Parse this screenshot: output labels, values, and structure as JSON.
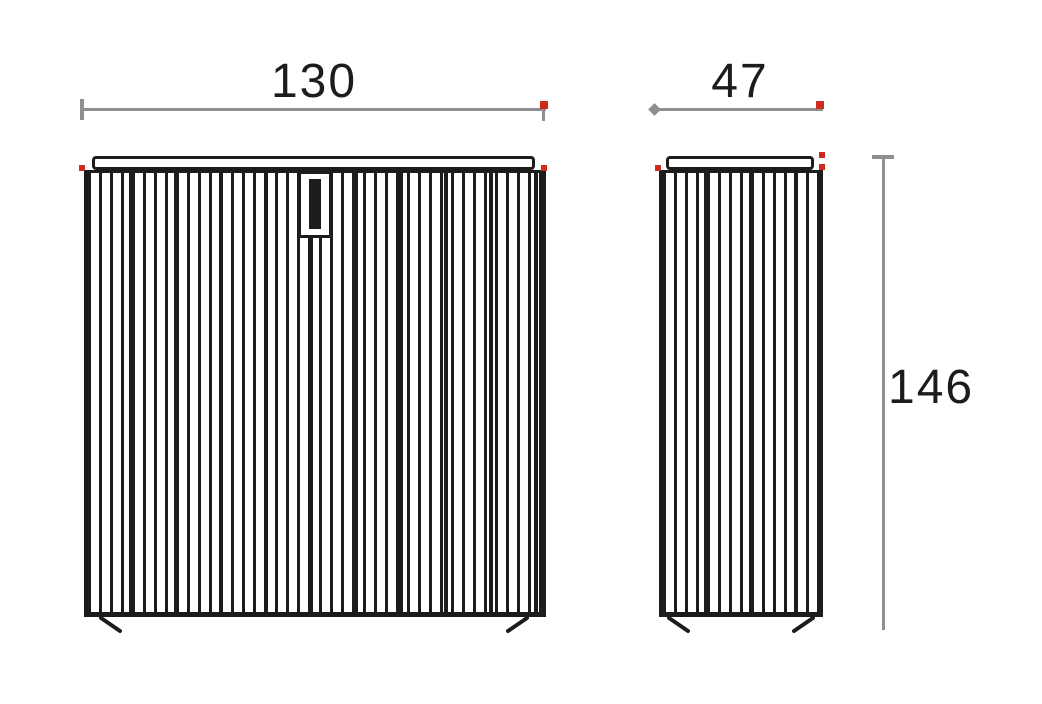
{
  "dimensions": {
    "width": "130",
    "depth": "47",
    "height": "146"
  },
  "views": {
    "front": "front-elevation",
    "side": "side-elevation"
  },
  "markers": {
    "corner_marker": "red-dot",
    "start_tick": "gray-tick",
    "height_top_tick": "gray-t-bar"
  },
  "colors": {
    "outline": "#1c1c1a",
    "dimension_line": "#8f8f8f",
    "marker_red": "#cc2b1d",
    "background": "#ffffff"
  }
}
